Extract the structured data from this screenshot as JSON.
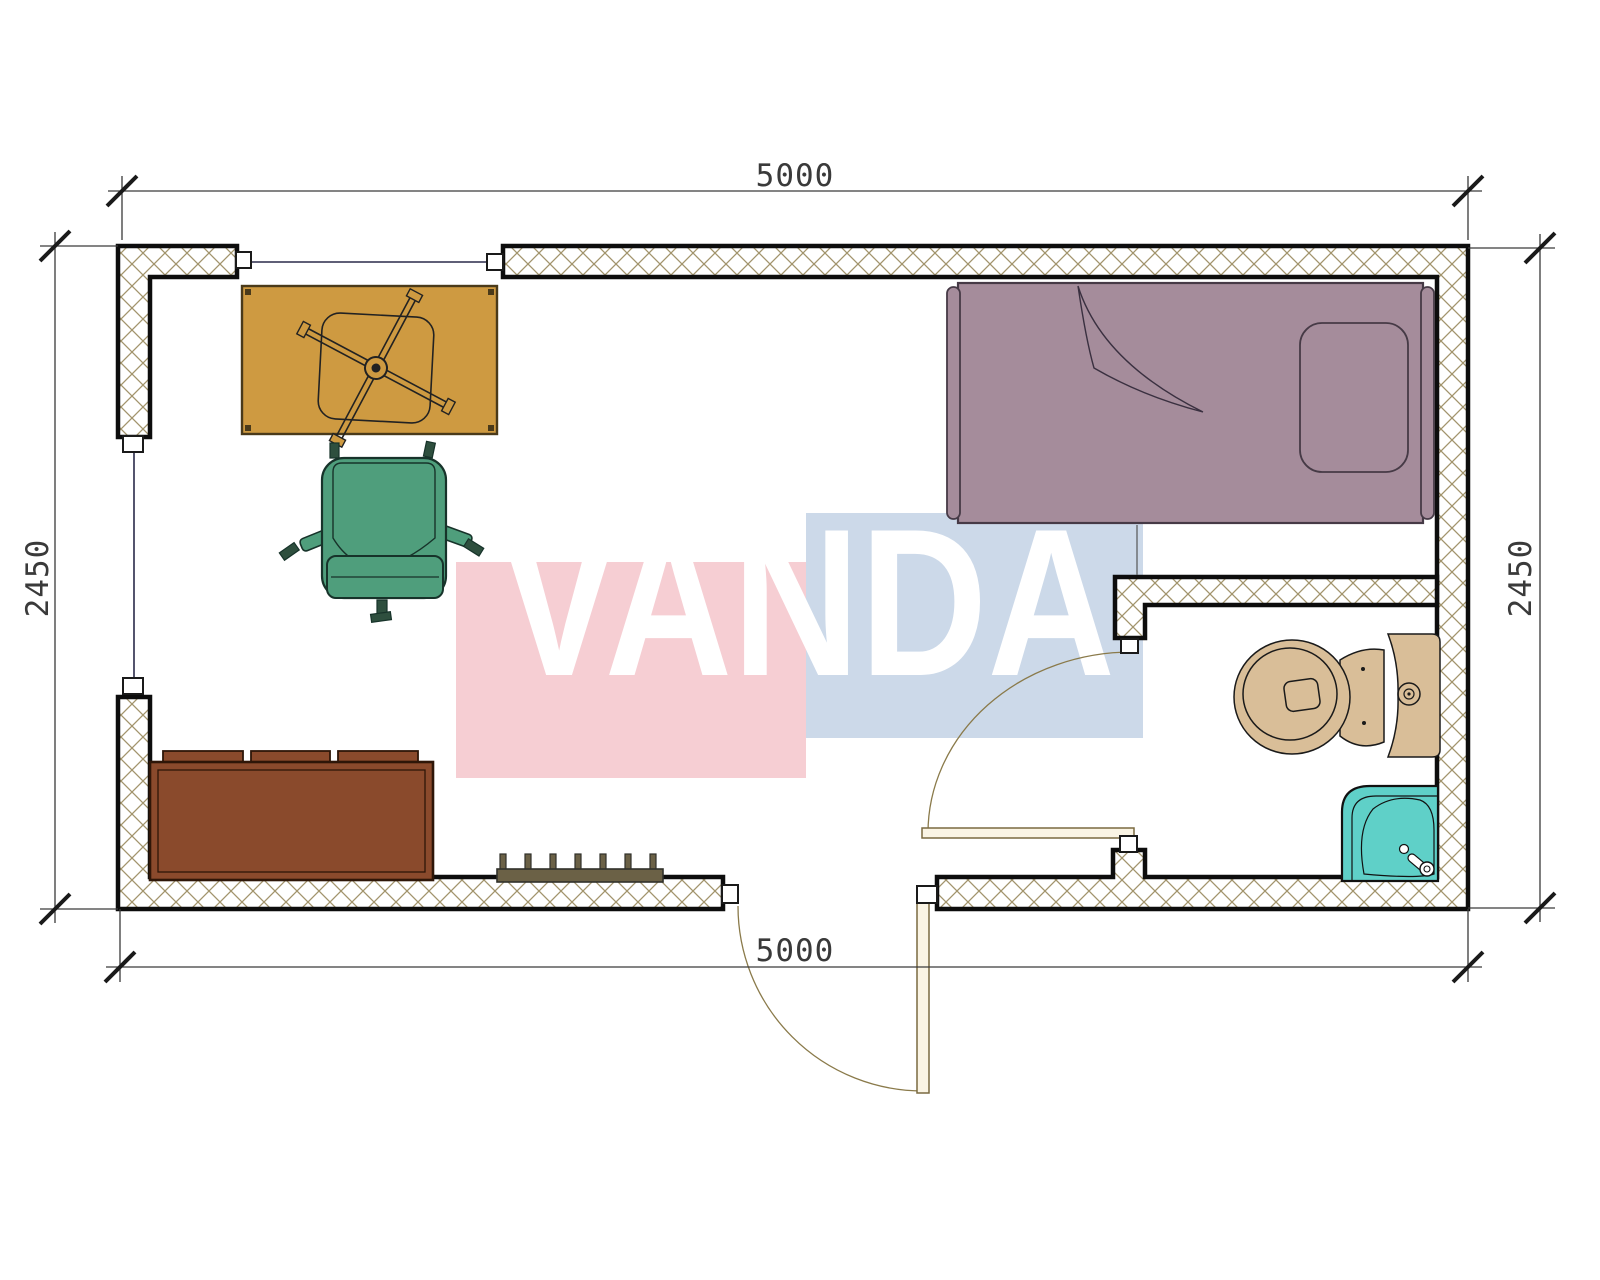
{
  "dimensions": {
    "top": "5000",
    "bottom": "5000",
    "left": "2450",
    "right": "2450"
  },
  "watermark": {
    "text": "VANDA",
    "pink": "#f6ced3",
    "blue": "#ccd9e9",
    "text_color": "#ffffff"
  },
  "colors": {
    "wall_hatch_line": "#a2946c",
    "wall_outline": "#0d0d0d",
    "dimension": "#3a3a3a",
    "desk": "#ce9a41",
    "desk_outline": "#4a3a1a",
    "office_chair": "#4f9e7c",
    "office_chair_outline": "#17332a",
    "sofa": "#8a4a2c",
    "sofa_outline": "#2e1608",
    "radiator": "#6b6146",
    "bed": "#a58c9b",
    "bed_outline": "#463a46",
    "toilet": "#d9be98",
    "toilet_outline": "#1a1a1a",
    "shower": "#5fd0c8",
    "door_leaf": "#faf4e4",
    "door_outline": "#7a6a40",
    "window_line": "#2a2a4a"
  },
  "furniture": [
    {
      "name": "desk",
      "color": "#ce9a41"
    },
    {
      "name": "desk-chair-symbol",
      "color": "#ce9a41"
    },
    {
      "name": "office-chair",
      "color": "#4f9e7c"
    },
    {
      "name": "sofa",
      "color": "#8a4a2c"
    },
    {
      "name": "radiator",
      "color": "#6b6146"
    },
    {
      "name": "single-bed",
      "color": "#a58c9b"
    },
    {
      "name": "toilet",
      "color": "#d9be98"
    },
    {
      "name": "shower-tray",
      "color": "#5fd0c8"
    },
    {
      "name": "entry-door",
      "color": "#faf4e4"
    },
    {
      "name": "bathroom-door",
      "color": "#faf4e4"
    }
  ]
}
